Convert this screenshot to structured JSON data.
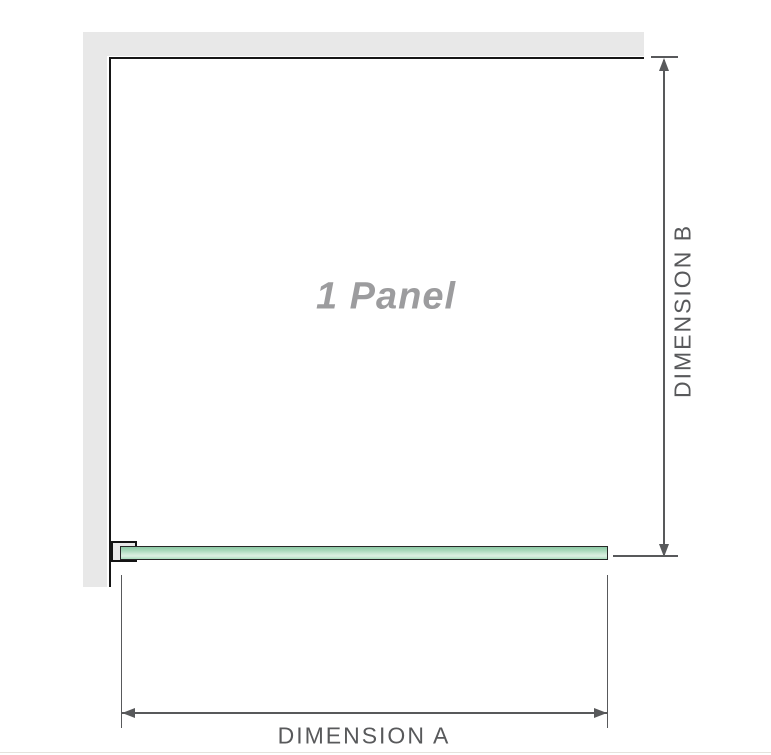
{
  "diagram": {
    "panel": {
      "label": "1 Panel"
    },
    "dimension_a": {
      "label": "DIMENSION A"
    },
    "dimension_b": {
      "label": "DIMENSION B"
    }
  },
  "colors": {
    "background": "#ffffff",
    "wall_fill": "#e8e8e8",
    "wall_edge_line": "#161616",
    "dimension_line": "#58595b",
    "dimension_text": "#58595b",
    "panel_label_text": "#9c9c9e",
    "glass_outline": "#272727",
    "glass_green_top": "#8cc9a5",
    "glass_green_light": "#ddf0e2",
    "glass_green_bottom": "#a9dcbc",
    "bracket_fill": "#e9e9e9",
    "bottom_divider": "#e4e2dd"
  }
}
